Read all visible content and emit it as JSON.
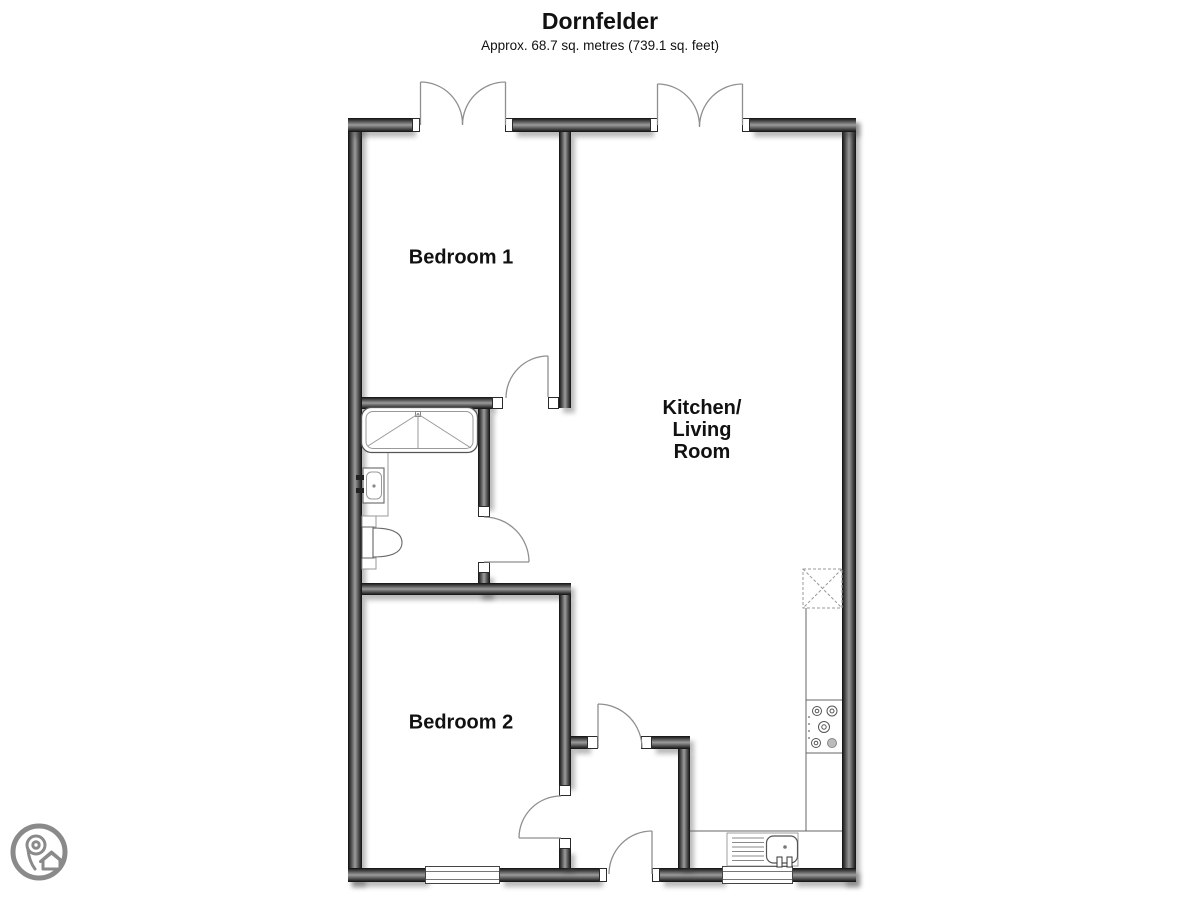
{
  "header": {
    "title": "Dornfelder",
    "subtitle": "Approx. 68.7 sq. metres (739.1 sq. feet)"
  },
  "rooms": {
    "bedroom1": {
      "label": "Bedroom 1"
    },
    "bedroom2": {
      "label": "Bedroom 2"
    },
    "kitchen_living": {
      "line1": "Kitchen/",
      "line2": "Living",
      "line3": "Room"
    }
  },
  "fixtures": {
    "bathroom": [
      "bathtub-with-shower",
      "washbasin",
      "toilet"
    ],
    "kitchen": [
      "counter",
      "hob",
      "sink-with-drainer",
      "appliance-space-dashed"
    ]
  },
  "logo": {
    "icon": "map-pin-house-logo"
  },
  "colors": {
    "wall_dark": "#101010",
    "wall_light": "#9b9b9b",
    "door_arc": "#8f8f8f",
    "fixture_line": "#666666",
    "text": "#111111",
    "logo_gray": "#8a8a8a"
  }
}
